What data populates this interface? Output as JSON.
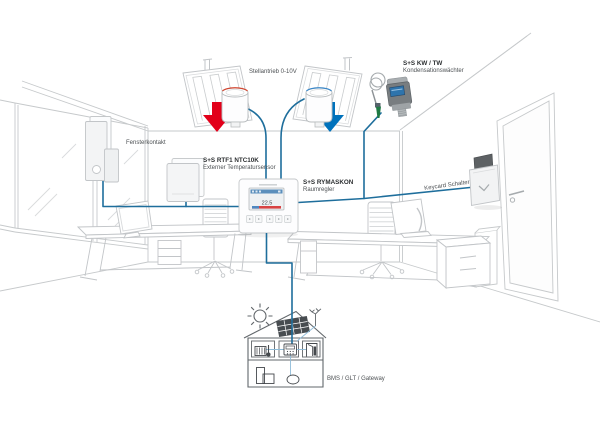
{
  "diagram": {
    "type": "room-automation-schematic",
    "labels": {
      "actuator": {
        "text": "Stellantrieb 0-10V"
      },
      "condensation_monitor": {
        "name": "S+S KW / TW",
        "desc": "Kondensationswächter"
      },
      "window_contact": {
        "text": "Fensterkontakt"
      },
      "temp_sensor": {
        "name": "S+S RTF1 NTC10K",
        "desc": "Externer Temperatursensor"
      },
      "room_controller": {
        "name": "S+S RYMASKON",
        "desc": "Raumregler"
      },
      "keycard": {
        "text": "Keycard Schalter"
      },
      "bms": {
        "text": "BMS / GLT / Gateway"
      }
    },
    "controller_display": {
      "value": "22.5"
    },
    "colors": {
      "wire_blue": "#1e6e9c",
      "heating_arrow_red": "#e2001a",
      "cooling_arrow_blue": "#0072bc",
      "lineart_gray": "#c2c5c8",
      "house_gray": "#62676b",
      "label_text": "#2c2f31"
    }
  }
}
